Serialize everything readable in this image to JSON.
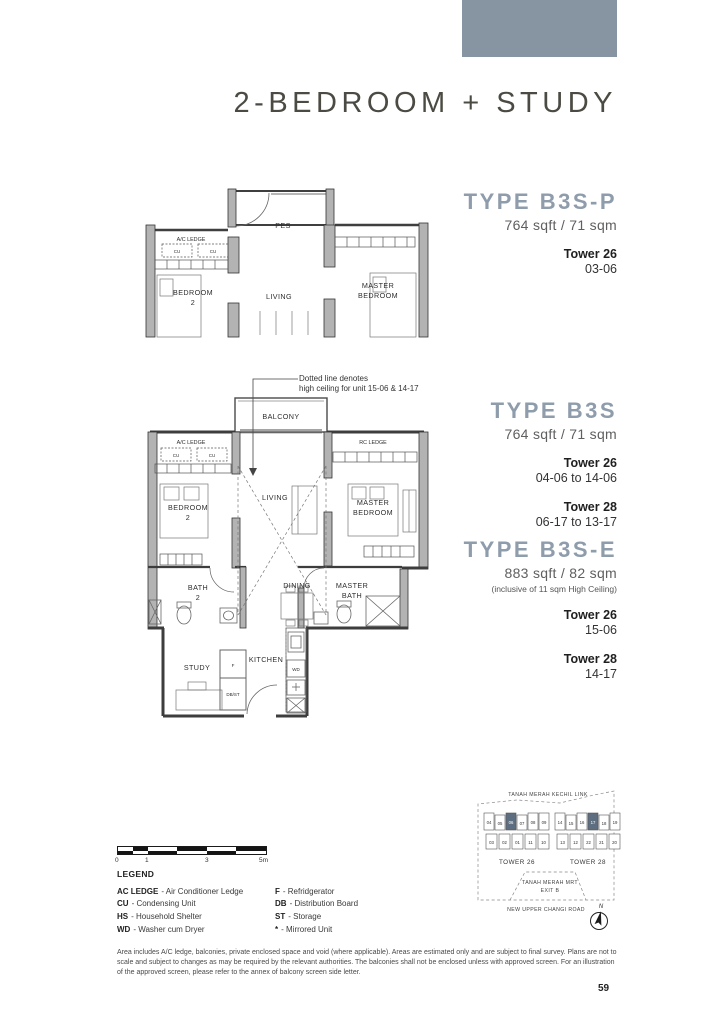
{
  "page": {
    "title": "2-BEDROOM + STUDY",
    "page_number": "59"
  },
  "colors": {
    "accent": "#8795a3",
    "heading": "#8e9cab",
    "keyplan_highlight": "#5d6e80"
  },
  "types": [
    {
      "name": "TYPE B3S-P",
      "area": "764 sqft / 71 sqm",
      "note": "",
      "towers": [
        {
          "tower": "Tower 26",
          "units": "03-06"
        }
      ]
    },
    {
      "name": "TYPE B3S",
      "area": "764 sqft / 71 sqm",
      "note": "",
      "towers": [
        {
          "tower": "Tower 26",
          "units": "04-06 to 14-06"
        },
        {
          "tower": "Tower 28",
          "units": "06-17 to 13-17"
        }
      ]
    },
    {
      "name": "TYPE B3S-E",
      "area": "883 sqft / 82 sqm",
      "note": "(inclusive of 11 sqm High Ceiling)",
      "towers": [
        {
          "tower": "Tower 26",
          "units": "15-06"
        },
        {
          "tower": "Tower 28",
          "units": "14-17"
        }
      ]
    }
  ],
  "annotation": {
    "line1": "Dotted line denotes",
    "line2": "high ceiling for unit 15-06 & 14-17"
  },
  "plan_top": {
    "labels": {
      "pes": "PES",
      "ac_ledge": "A/C LEDGE",
      "cu1": "CU",
      "cu2": "CU",
      "bedroom2": [
        "BEDROOM",
        "2"
      ],
      "living": "LIVING",
      "master_bedroom": [
        "MASTER",
        "BEDROOM"
      ]
    }
  },
  "plan_main": {
    "labels": {
      "balcony": "BALCONY",
      "ac_ledge": "A/C LEDGE",
      "cu1": "CU",
      "cu2": "CU",
      "rc_ledge": "RC LEDGE",
      "bedroom2": [
        "BEDROOM",
        "2"
      ],
      "living": "LIVING",
      "master_bedroom": [
        "MASTER",
        "BEDROOM"
      ],
      "bath2": [
        "BATH",
        "2"
      ],
      "dining": "DINING",
      "master_bath": [
        "MASTER",
        "BATH"
      ],
      "study": "STUDY",
      "kitchen": "KITCHEN",
      "fridge": "F",
      "dbst": "DB/ST",
      "wd": "WD"
    }
  },
  "scale_bar": {
    "labels": [
      "0",
      "1",
      "3",
      "5m"
    ]
  },
  "legend": {
    "title": "LEGEND",
    "left": [
      {
        "abbr": "AC LEDGE",
        "rest": "- Air Conditioner Ledge"
      },
      {
        "abbr": "CU",
        "rest": "- Condensing Unit"
      },
      {
        "abbr": "HS",
        "rest": "- Household Shelter"
      },
      {
        "abbr": "WD",
        "rest": "- Washer cum Dryer"
      }
    ],
    "right": [
      {
        "abbr": "F",
        "rest": "- Refridgerator"
      },
      {
        "abbr": "DB",
        "rest": "- Distribution Board"
      },
      {
        "abbr": "ST",
        "rest": "- Storage"
      },
      {
        "abbr": "*",
        "rest": "- Mirrored Unit"
      }
    ]
  },
  "keyplan": {
    "road_top": "TANAH MERAH KECHIL LINK",
    "mrt": [
      "TANAH MERAH MRT",
      "EXIT B"
    ],
    "road_bottom": "NEW UPPER CHANGI ROAD",
    "north": "N",
    "towers": [
      {
        "name": "TOWER 26",
        "top_row": [
          "04",
          "05",
          "06",
          "07",
          "08",
          "09"
        ],
        "bottom_row": [
          "03",
          "02",
          "01",
          "11",
          "10"
        ],
        "highlighted": "06"
      },
      {
        "name": "TOWER 28",
        "top_row": [
          "14",
          "15",
          "16",
          "17",
          "18",
          "19"
        ],
        "bottom_row": [
          "13",
          "12",
          "22",
          "21",
          "20"
        ],
        "highlighted": "17"
      }
    ]
  },
  "disclaimer": "Area includes A/C ledge, balconies, private enclosed space and void (where applicable). Areas are estimated only and are subject to final survey. Plans are not to scale and subject to changes as may be required by the relevant authorities. The balconies shall not be enclosed unless with approved screen. For an illustration of the approved screen, please refer to the annex of balcony screen side letter."
}
